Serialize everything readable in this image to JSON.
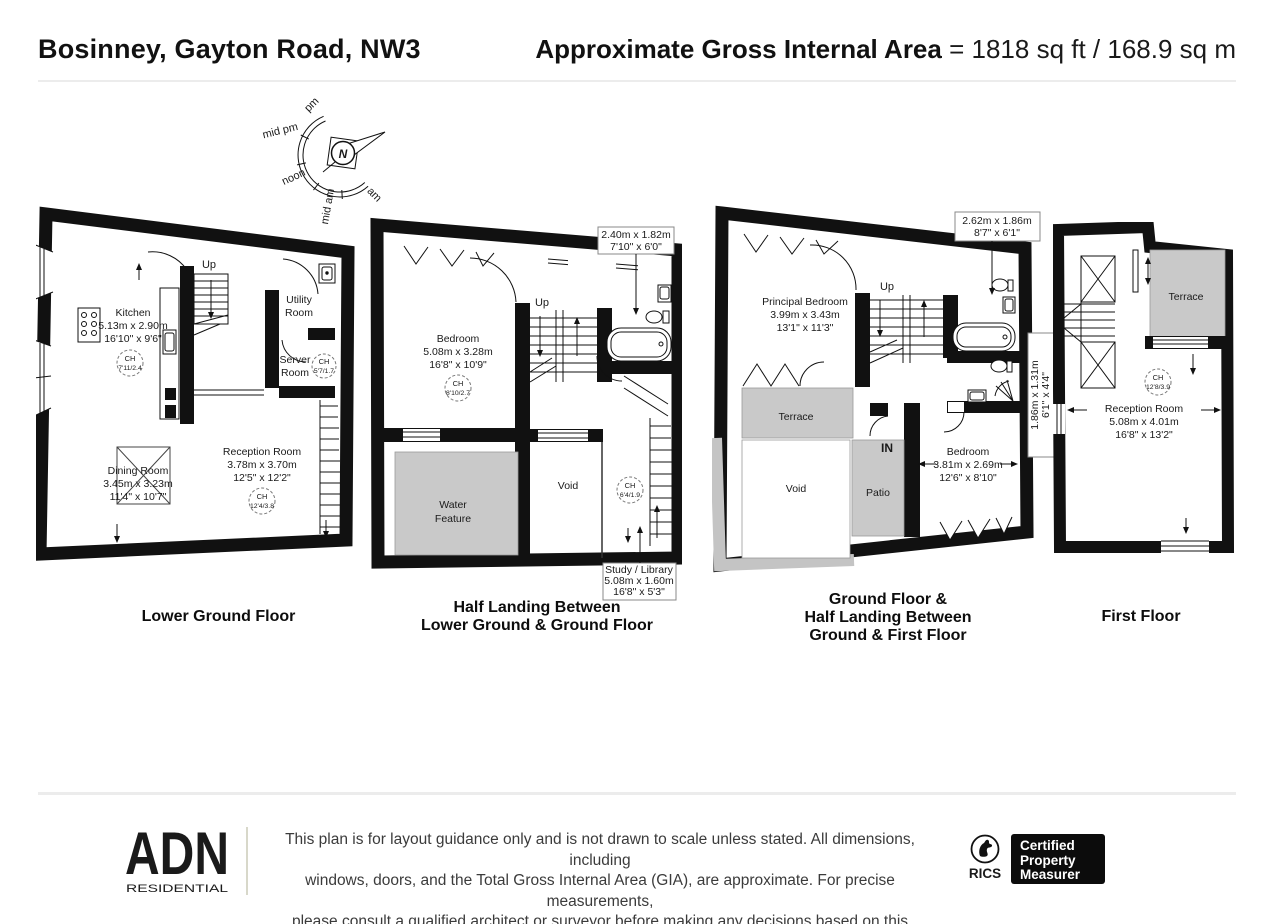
{
  "header": {
    "title": "Bosinney, Gayton Road, NW3",
    "area_label": "Approximate Gross Internal Area",
    "area_value": "= 1818 sq ft / 168.9 sq m"
  },
  "compass": {
    "north": "N",
    "pm": "pm",
    "mid_pm": "mid pm",
    "noon": "noon",
    "mid_am": "mid am",
    "am": "am"
  },
  "lower_ground": {
    "caption": "Lower Ground Floor",
    "up": "Up",
    "kitchen": {
      "name": "Kitchen",
      "metric": "5.13m x 2.90m",
      "imperial": "16'10\" x 9'6\"",
      "ch": "CH",
      "ch_value": "7'11/2.4"
    },
    "utility": {
      "line1": "Utility",
      "line2": "Room"
    },
    "server": {
      "line1": "Server",
      "line2": "Room",
      "ch": "CH",
      "ch_value": "5'7/1.7"
    },
    "dining": {
      "name": "Dining Room",
      "metric": "3.45m x 3.23m",
      "imperial": "11'4\" x 10'7\""
    },
    "reception": {
      "name": "Reception Room",
      "metric": "3.78m x 3.70m",
      "imperial": "12'5\" x 12'2\"",
      "ch": "CH",
      "ch_value": "12'4/3.8"
    }
  },
  "half_landing": {
    "caption_line1": "Half Landing Between",
    "caption_line2": "Lower Ground & Ground Floor",
    "up": "Up",
    "bedroom": {
      "name": "Bedroom",
      "metric": "5.08m x 3.28m",
      "imperial": "16'8\" x 10'9\"",
      "ch": "CH",
      "ch_value": "8'10/2.7"
    },
    "bath_callout": {
      "metric": "2.40m x 1.82m",
      "imperial": "7'10\" x 6'0\""
    },
    "water_feature": {
      "line1": "Water",
      "line2": "Feature"
    },
    "void_label": "Void",
    "landing_ch": {
      "ch": "CH",
      "ch_value": "6'4/1.9"
    },
    "study_callout": {
      "name": "Study / Library",
      "metric": "5.08m x 1.60m",
      "imperial": "16'8\" x 5'3\""
    }
  },
  "ground": {
    "caption_line1": "Ground Floor &",
    "caption_line2": "Half Landing Between",
    "caption_line3": "Ground & First Floor",
    "up": "Up",
    "in_label": "IN",
    "principal_bedroom": {
      "name": "Principal Bedroom",
      "metric": "3.99m x 3.43m",
      "imperial": "13'1\" x 11'3\""
    },
    "bath_callout": {
      "metric": "2.62m x 1.86m",
      "imperial": "8'7\" x 6'1\""
    },
    "shower_callout": {
      "metric": "1.86m x 1.31m",
      "imperial": "6'1\" x 4'4\""
    },
    "terrace": "Terrace",
    "void_label": "Void",
    "patio": "Patio",
    "bedroom": {
      "name": "Bedroom",
      "metric": "3.81m x 2.69m",
      "imperial": "12'6\" x 8'10\""
    }
  },
  "first": {
    "caption": "First Floor",
    "terrace": "Terrace",
    "reception": {
      "name": "Reception Room",
      "metric": "5.08m x 4.01m",
      "imperial": "16'8\" x 13'2\"",
      "ch": "CH",
      "ch_value": "12'8/3.9"
    }
  },
  "footer": {
    "logo_text": "ADN",
    "logo_sub": "RESIDENTIAL",
    "disclaimer_line1": "This plan is for layout guidance only and is not drawn to scale unless stated. All dimensions, including",
    "disclaimer_line2": "windows, doors, and the Total Gross Internal Area (GIA), are approximate. For precise measurements,",
    "disclaimer_line3": "please consult a qualified architect or surveyor before making any decisions based on this plan.",
    "rics": "RICS",
    "badge_line1": "Certified",
    "badge_line2": "Property",
    "badge_line3": "Measurer"
  }
}
